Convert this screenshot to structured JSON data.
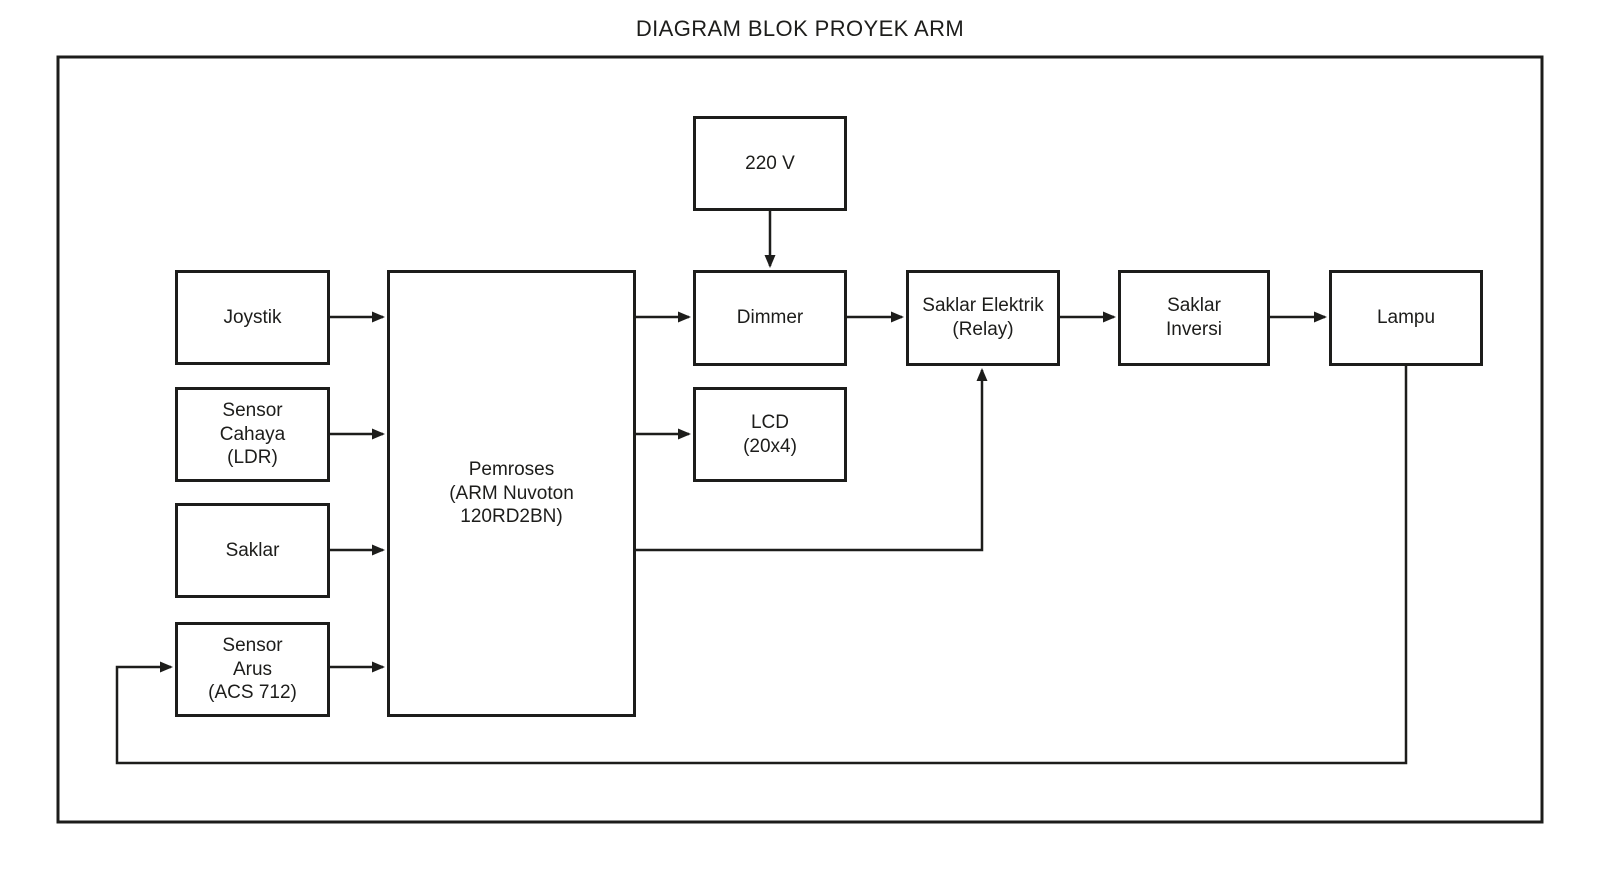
{
  "diagram": {
    "title": "DIAGRAM BLOK PROYEK ARM",
    "line_color": "#1d1d1b",
    "background_color": "#ffffff"
  },
  "nodes": {
    "v220": {
      "label": "220 V"
    },
    "joystik": {
      "label": "Joystik"
    },
    "sensor_cahaya": {
      "label": "Sensor\nCahaya\n(LDR)"
    },
    "saklar": {
      "label": "Saklar"
    },
    "sensor_arus": {
      "label": "Sensor\nArus\n(ACS 712)"
    },
    "pemroses": {
      "label": "Pemroses\n(ARM Nuvoton\n120RD2BN)"
    },
    "dimmer": {
      "label": "Dimmer"
    },
    "lcd": {
      "label": "LCD\n(20x4)"
    },
    "saklar_elektrik": {
      "label": "Saklar Elektrik\n(Relay)"
    },
    "saklar_inversi": {
      "label": "Saklar\nInversi"
    },
    "lampu": {
      "label": "Lampu"
    }
  },
  "edges": [
    {
      "from": "v220",
      "to": "dimmer"
    },
    {
      "from": "joystik",
      "to": "pemroses"
    },
    {
      "from": "sensor_cahaya",
      "to": "pemroses"
    },
    {
      "from": "saklar",
      "to": "pemroses"
    },
    {
      "from": "sensor_arus",
      "to": "pemroses"
    },
    {
      "from": "pemroses",
      "to": "dimmer"
    },
    {
      "from": "pemroses",
      "to": "lcd"
    },
    {
      "from": "pemroses",
      "to": "saklar_elektrik"
    },
    {
      "from": "dimmer",
      "to": "saklar_elektrik"
    },
    {
      "from": "saklar_elektrik",
      "to": "saklar_inversi"
    },
    {
      "from": "saklar_inversi",
      "to": "lampu"
    },
    {
      "from": "lampu",
      "to": "sensor_arus"
    }
  ]
}
